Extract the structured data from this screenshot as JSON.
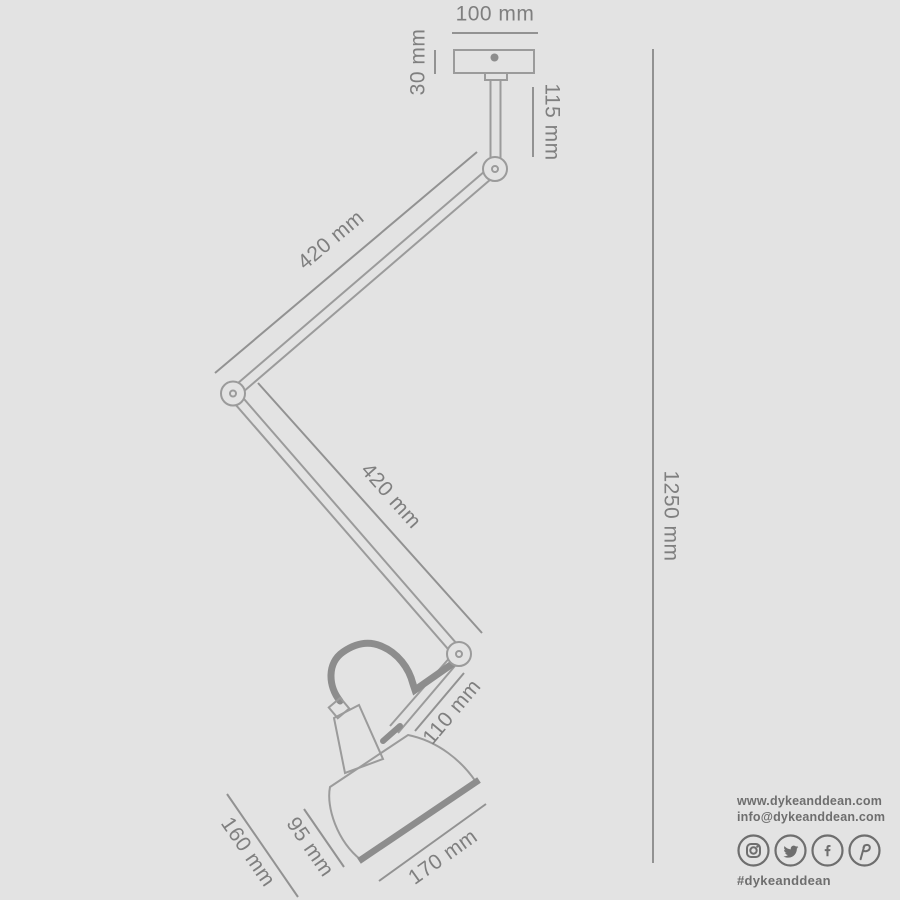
{
  "drawing": {
    "title": "articulated ceiling lamp dimension drawing",
    "dims": {
      "plate_width": "100 mm",
      "canopy_height": "30 mm",
      "stem_drop": "115 mm",
      "upper_arm": "420 mm",
      "lower_arm": "420 mm",
      "overall_drop": "1250 mm",
      "head_arm": "110 mm",
      "shade_height": "95 mm",
      "shade_depth": "160 mm",
      "shade_width": "170 mm"
    }
  },
  "footer": {
    "website": "www.dykeanddean.com",
    "email": "info@dykeanddean.com",
    "hashtag": "#dykeanddean",
    "social_icons": [
      "instagram",
      "twitter",
      "facebook",
      "pinterest"
    ]
  },
  "colors": {
    "background": "#e3e3e3",
    "outline": "#9b9b9b",
    "thick_line": "#8d8d8d",
    "dimension_text": "#7f7f7f",
    "footer_text": "#6e6e6e"
  }
}
